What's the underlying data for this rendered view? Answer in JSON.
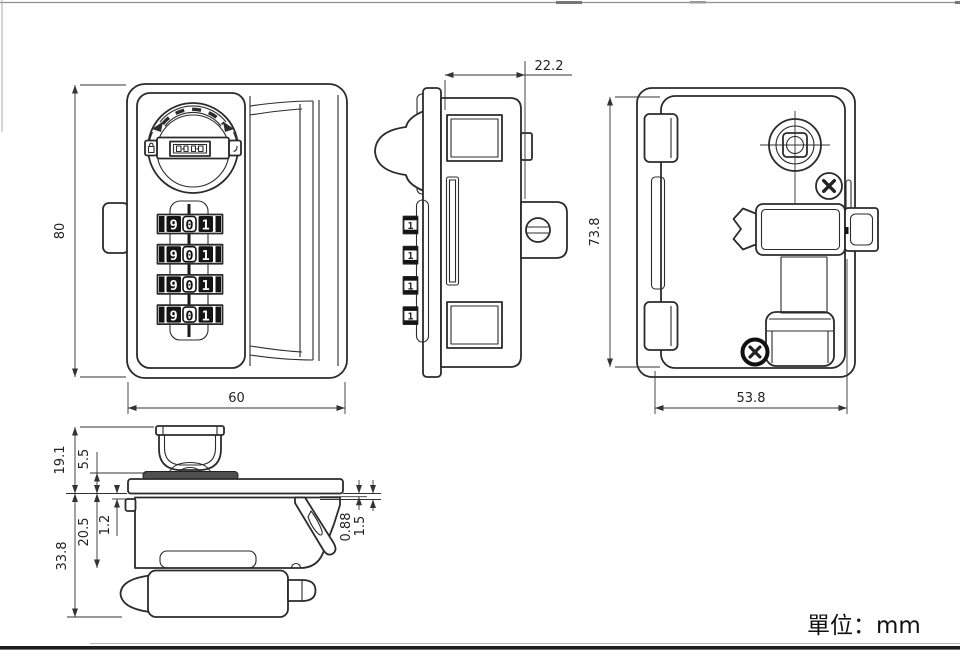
{
  "drawing": {
    "unit_label": "單位：mm",
    "colors": {
      "line": "#2b2b2b",
      "background": "#ffffff",
      "wheel_band": "#141414"
    },
    "front_view": {
      "dim_height": "80",
      "dim_width": "60",
      "wheels": [
        {
          "digits": [
            "9",
            "0",
            "1"
          ]
        },
        {
          "digits": [
            "9",
            "0",
            "1"
          ]
        },
        {
          "digits": [
            "9",
            "0",
            "1"
          ]
        },
        {
          "digits": [
            "9",
            "0",
            "1"
          ]
        }
      ]
    },
    "side_view": {
      "dim_depth": "22.2",
      "wheel_digits": [
        "1",
        "1",
        "1",
        "1"
      ]
    },
    "back_view": {
      "dim_height": "73.8",
      "dim_width": "53.8"
    },
    "bottom_view": {
      "dim_knob_height": "19.1",
      "dim_knob_base": "5.5",
      "dim_body_depth": "20.5",
      "dim_tab_gap": "1.2",
      "dim_total_depth": "33.8",
      "dim_panel_min": "0.88",
      "dim_panel_max": "1.5"
    }
  }
}
